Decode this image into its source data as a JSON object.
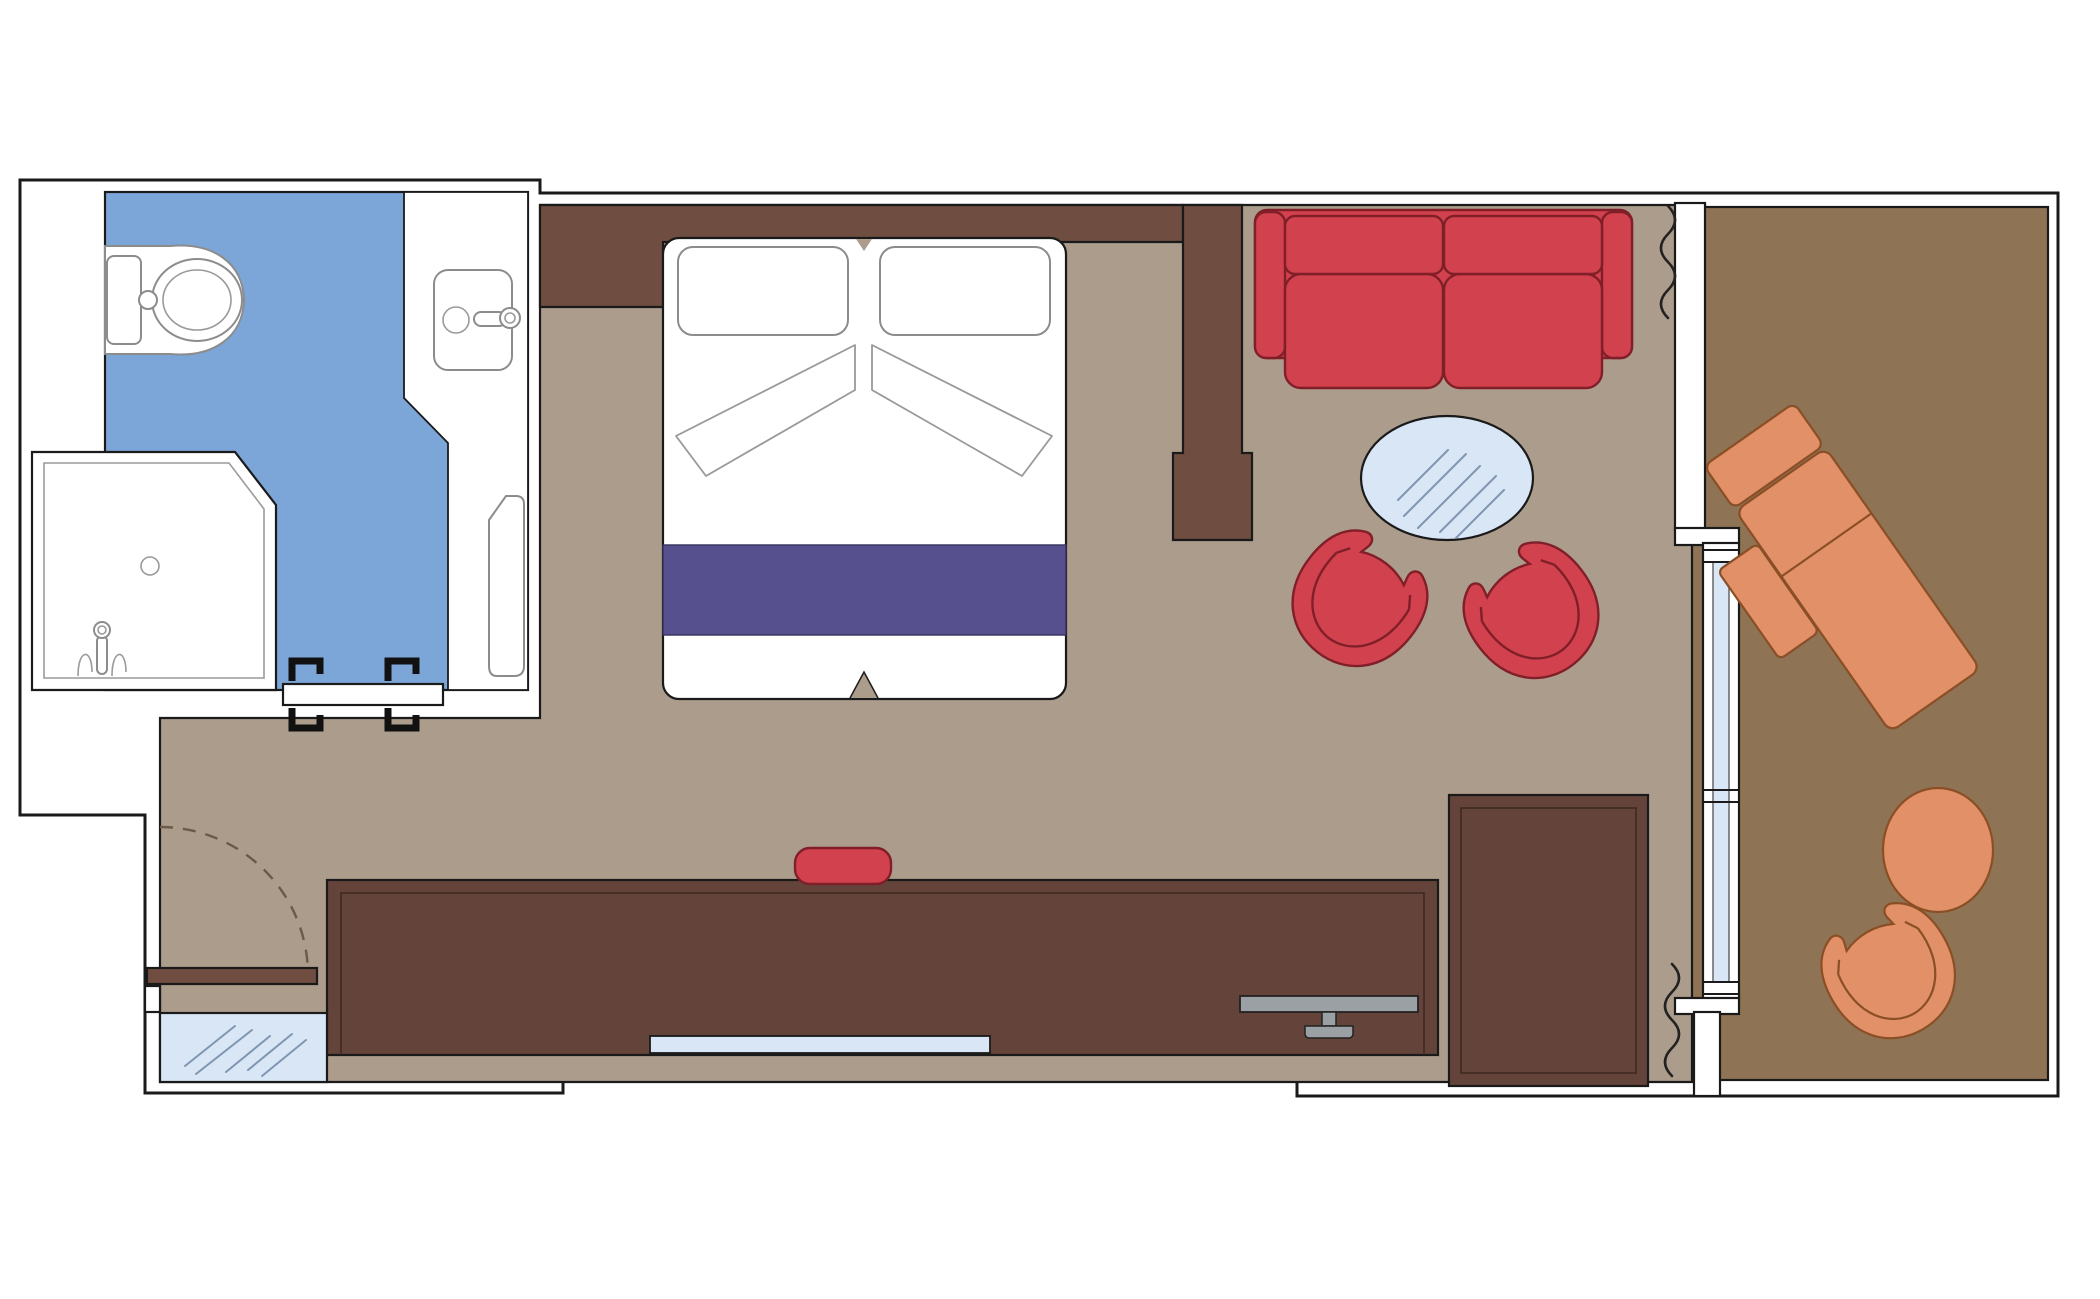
{
  "palette": {
    "outline": "#1a1a1a",
    "bathroom_floor": "#7CA6D8",
    "room_floor": "#AC9C8C",
    "balcony_floor": "#8F7355",
    "wall_wood": "#6F4E41",
    "cabinet_wood": "#64443A",
    "upholstery_red": "#D2414E",
    "upholstery_red_outline": "#801F28",
    "bed_runner_purple": "#57508E",
    "glass_blue": "#D8E6F6",
    "glass_hatch": "#8096B0",
    "furniture_orange": "#E29068",
    "furniture_orange_outline": "#8A4F26",
    "tv_gray": "#9AA0A4",
    "white_fixture": "#FFFFFF"
  },
  "labels": {
    "plan": "Cabin floor plan with balcony",
    "shell": "Exterior walls",
    "bathroom": "Bathroom",
    "toilet": "Toilet",
    "toilet_flush": "Flush button",
    "washbasin": "Washbasin with tap",
    "vanity": "Vanity counter",
    "shower": "Shower cabin",
    "shower_drain": "Shower drain",
    "shower_tap": "Shower tap",
    "bath_door": "Sliding bathroom door",
    "cabin": "Cabin room",
    "headboard": "Headboard wall",
    "divider": "Partition wall column",
    "bed": "Double bed",
    "pillow_left": "Pillow",
    "pillow_right": "Pillow",
    "sheet_fold_left": "Folded sheet",
    "sheet_fold_right": "Folded sheet",
    "bed_runner": "Bed runner",
    "sofa": "Two-seat sofa",
    "coffee_table": "Oval glass coffee table",
    "armchair_left": "Tub armchair",
    "armchair_right": "Tub armchair",
    "desk": "Desk / dresser unit",
    "desk_mirror": "Mirror strip",
    "tv": "Flat-screen TV",
    "stool": "Stool",
    "wardrobe": "Wardrobe",
    "entrance_door": "Entrance door",
    "entrance_swing": "Door swing",
    "entry_mirror": "Full-length mirror panel",
    "curtain_top": "Curtain",
    "curtain_bottom": "Curtain",
    "balcony_window": "Balcony door / window",
    "balcony": "Balcony",
    "lounger": "Sun lounger",
    "balcony_table": "Round balcony table",
    "balcony_chair": "Balcony tub chair"
  }
}
